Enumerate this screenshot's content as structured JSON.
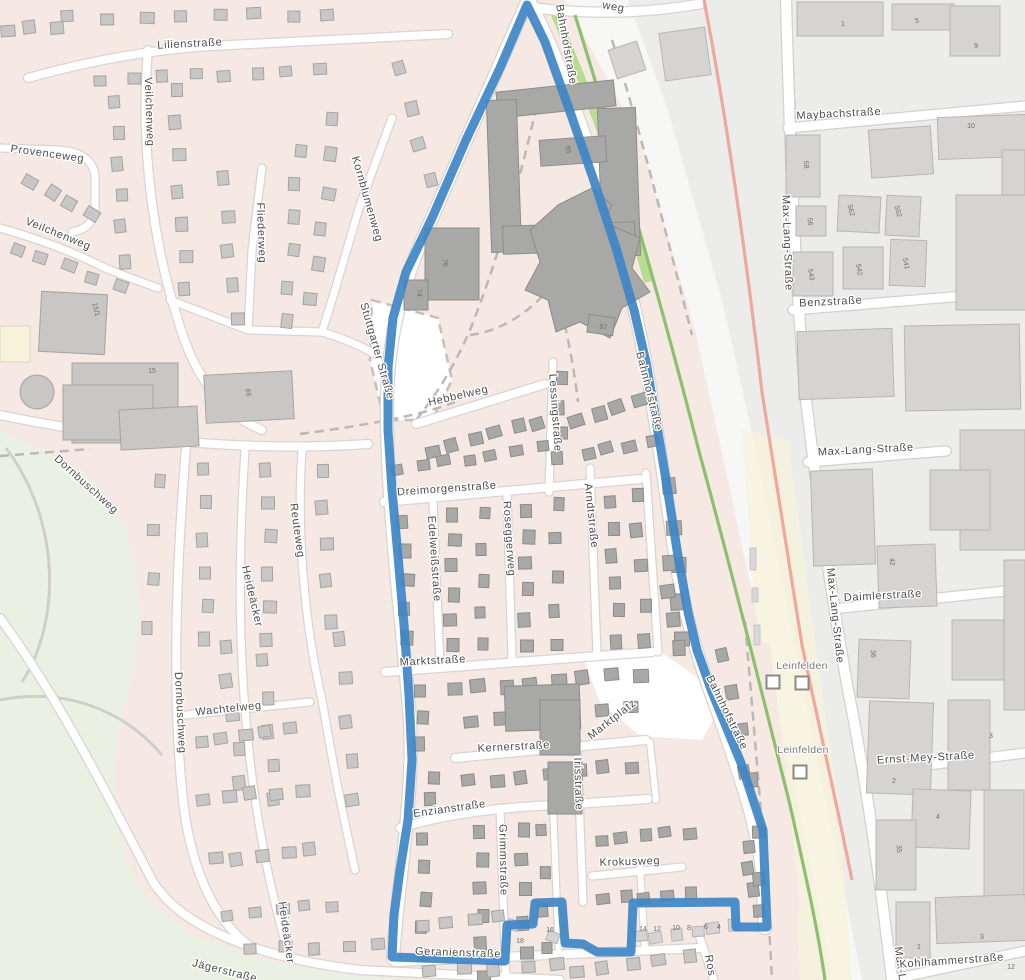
{
  "map": {
    "type": "street-map",
    "style": "openstreetmap-carto",
    "boundary": {
      "description": "blue district outline",
      "color": "#3E86C6"
    },
    "colors": {
      "residential_bg": "#F6E8E3",
      "park_green": "#EBF1E2",
      "grass_strip": "#B7DC92",
      "industrial_bg": "#ECEDEB",
      "rail_corridor": "#F7F7F5",
      "rail_yellow_band": "#F6F3DC",
      "road_fill": "#FFFFFF",
      "building_residential": "#C8C7C5",
      "building_district": "#A8A8A6",
      "building_industrial": "#D2D4D2",
      "railway_line_green": "#8BC16C",
      "railway_line_red": "#F09A90",
      "boundary_blue": "#3E86C6",
      "label_text": "#4C4C4C"
    },
    "station": {
      "name": "Leinfelden",
      "marker_count": 3
    },
    "station_labels": [
      {
        "text": "Leinfelden",
        "x": 802,
        "y": 669,
        "r": 0
      },
      {
        "text": "Leinfelden",
        "x": 803,
        "y": 753,
        "r": 0
      }
    ],
    "street_labels": [
      {
        "text": "Lilienstraße",
        "x": 190,
        "y": 47,
        "r": -3
      },
      {
        "text": "Veilchenweg",
        "x": 146,
        "y": 112,
        "r": 88
      },
      {
        "text": "Provenceweg",
        "x": 47,
        "y": 157,
        "r": 8
      },
      {
        "text": "Veilchenweg",
        "x": 57,
        "y": 237,
        "r": 22
      },
      {
        "text": "Fliederweg",
        "x": 258,
        "y": 233,
        "r": 88
      },
      {
        "text": "Kornblumenweg",
        "x": 364,
        "y": 200,
        "r": 74
      },
      {
        "text": "Stuttgarter Straße",
        "x": 374,
        "y": 352,
        "r": 74
      },
      {
        "text": "Dornbuschweg",
        "x": 84,
        "y": 487,
        "r": 42
      },
      {
        "text": "Reuteweg",
        "x": 294,
        "y": 531,
        "r": 82
      },
      {
        "text": "Heideäcker",
        "x": 249,
        "y": 597,
        "r": 77
      },
      {
        "text": "Wachtelweg",
        "x": 229,
        "y": 712,
        "r": -6
      },
      {
        "text": "Dornbuschweg",
        "x": 177,
        "y": 713,
        "r": 87
      },
      {
        "text": "Heideäcker",
        "x": 283,
        "y": 933,
        "r": 82
      },
      {
        "text": "Jägerstraße",
        "x": 224,
        "y": 974,
        "r": 14
      },
      {
        "text": "Bahnhofstraße",
        "x": 563,
        "y": 45,
        "r": 80
      },
      {
        "text": "Bahnhofstraße",
        "x": 646,
        "y": 392,
        "r": 76
      },
      {
        "text": "Bahnhofstraße",
        "x": 724,
        "y": 714,
        "r": 64
      },
      {
        "text": "Hebbelweg",
        "x": 459,
        "y": 399,
        "r": -13
      },
      {
        "text": "Lessingstraße",
        "x": 552,
        "y": 413,
        "r": 86
      },
      {
        "text": "Dreimorgenstraße",
        "x": 447,
        "y": 492,
        "r": -4
      },
      {
        "text": "Edelweißstraße",
        "x": 431,
        "y": 559,
        "r": 86
      },
      {
        "text": "Roseggerweg",
        "x": 506,
        "y": 539,
        "r": 86
      },
      {
        "text": "Arndtstraße",
        "x": 588,
        "y": 516,
        "r": 84
      },
      {
        "text": "Marktstraße",
        "x": 433,
        "y": 664,
        "r": -3
      },
      {
        "text": "Kernerstraße",
        "x": 514,
        "y": 750,
        "r": -3
      },
      {
        "text": "Marktplatz",
        "x": 614,
        "y": 722,
        "r": -38
      },
      {
        "text": "Irisstraße",
        "x": 575,
        "y": 784,
        "r": 88
      },
      {
        "text": "Enzianstraße",
        "x": 450,
        "y": 812,
        "r": -8
      },
      {
        "text": "Grimmstraße",
        "x": 500,
        "y": 860,
        "r": 89
      },
      {
        "text": "Krokusweg",
        "x": 630,
        "y": 865,
        "r": -2
      },
      {
        "text": "Geranienstraße",
        "x": 458,
        "y": 956,
        "r": 2
      },
      {
        "text": "Ros",
        "x": 707,
        "y": 966,
        "r": 80
      },
      {
        "text": "weg",
        "x": 613,
        "y": 10,
        "r": 10
      },
      {
        "text": "Maybachstraße",
        "x": 839,
        "y": 117,
        "r": -3
      },
      {
        "text": "Max-Lang-Straße",
        "x": 784,
        "y": 243,
        "r": 88
      },
      {
        "text": "Benzstraße",
        "x": 831,
        "y": 305,
        "r": -3
      },
      {
        "text": "Max-Lang-Straße",
        "x": 866,
        "y": 453,
        "r": -3
      },
      {
        "text": "Max-Lang-Straße",
        "x": 832,
        "y": 616,
        "r": 84
      },
      {
        "text": "Daimlerstraße",
        "x": 883,
        "y": 599,
        "r": -3
      },
      {
        "text": "Ernst-Mey-Straße",
        "x": 926,
        "y": 761,
        "r": -3
      },
      {
        "text": "Max-L",
        "x": 897,
        "y": 964,
        "r": 82
      },
      {
        "text": "Kohlhammerstraße",
        "x": 952,
        "y": 964,
        "r": -4
      }
    ],
    "house_numbers": [
      {
        "text": "85",
        "x": 566,
        "y": 150,
        "r": 80
      },
      {
        "text": "76",
        "x": 443,
        "y": 263,
        "r": 85
      },
      {
        "text": "74",
        "x": 417,
        "y": 293,
        "r": 85
      },
      {
        "text": "87",
        "x": 603,
        "y": 329,
        "r": 10
      },
      {
        "text": "65",
        "x": 246,
        "y": 393,
        "r": 80
      },
      {
        "text": "15",
        "x": 152,
        "y": 373,
        "r": 0
      },
      {
        "text": "15/1",
        "x": 94,
        "y": 310,
        "r": 75
      },
      {
        "text": "1",
        "x": 843,
        "y": 26,
        "r": 0
      },
      {
        "text": "5",
        "x": 917,
        "y": 23,
        "r": 0
      },
      {
        "text": "9",
        "x": 976,
        "y": 48,
        "r": 0
      },
      {
        "text": "10",
        "x": 971,
        "y": 128,
        "r": 0
      },
      {
        "text": "58",
        "x": 804,
        "y": 165,
        "r": 80
      },
      {
        "text": "56",
        "x": 808,
        "y": 222,
        "r": 80
      },
      {
        "text": "562",
        "x": 849,
        "y": 211,
        "r": 75
      },
      {
        "text": "552",
        "x": 896,
        "y": 212,
        "r": 75
      },
      {
        "text": "543",
        "x": 809,
        "y": 275,
        "r": 80
      },
      {
        "text": "542",
        "x": 857,
        "y": 270,
        "r": 80
      },
      {
        "text": "541",
        "x": 904,
        "y": 264,
        "r": 80
      },
      {
        "text": "42",
        "x": 890,
        "y": 562,
        "r": 85
      },
      {
        "text": "36",
        "x": 871,
        "y": 654,
        "r": 85
      },
      {
        "text": "4",
        "x": 938,
        "y": 819,
        "r": 0
      },
      {
        "text": "3",
        "x": 991,
        "y": 738,
        "r": 0
      },
      {
        "text": "2",
        "x": 894,
        "y": 783,
        "r": 0
      },
      {
        "text": "35",
        "x": 897,
        "y": 849,
        "r": 85
      },
      {
        "text": "3",
        "x": 982,
        "y": 939,
        "r": 0
      },
      {
        "text": "1",
        "x": 919,
        "y": 949,
        "r": 0
      },
      {
        "text": "12",
        "x": 1011,
        "y": 969,
        "r": 0
      },
      {
        "text": "16",
        "x": 550,
        "y": 932,
        "r": 0
      },
      {
        "text": "18",
        "x": 520,
        "y": 943,
        "r": 0
      },
      {
        "text": "14",
        "x": 643,
        "y": 931,
        "r": 0
      },
      {
        "text": "12",
        "x": 657,
        "y": 931,
        "r": 0
      },
      {
        "text": "10",
        "x": 676,
        "y": 930,
        "r": 0
      },
      {
        "text": "8",
        "x": 689,
        "y": 930,
        "r": 0
      },
      {
        "text": "6",
        "x": 706,
        "y": 929,
        "r": 0
      },
      {
        "text": "4",
        "x": 719,
        "y": 929,
        "r": 0
      }
    ]
  }
}
